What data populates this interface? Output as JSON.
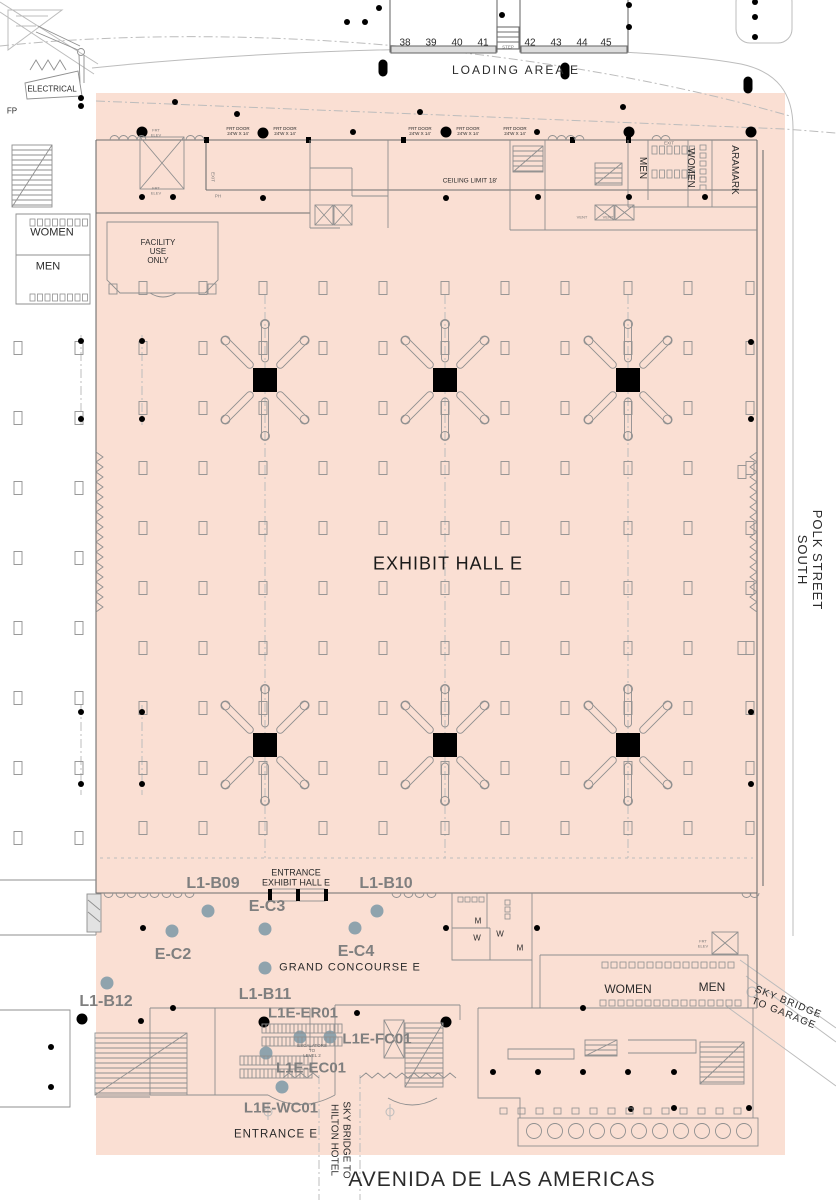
{
  "colors": {
    "hall_fill": "#fadfd3",
    "wall": "#6f6f6f",
    "road": "#bcbcbc",
    "marker": "#8fa3ad",
    "label_gray": "#7f7f7f",
    "black": "#000000"
  },
  "loading_dock": {
    "area_label": "LOADING AREA E",
    "numbers": [
      "38",
      "39",
      "40",
      "41",
      "42",
      "43",
      "44",
      "45"
    ],
    "step_label": "STEP"
  },
  "site": {
    "electrical": "ELECTRICAL",
    "fp": "FP",
    "polk_line1": "POLK STREET",
    "polk_line2": "SOUTH",
    "avenida": "AVENIDA DE LAS AMERICAS",
    "sky_garage_line1": "SKY BRIDGE",
    "sky_garage_line2": "TO GARAGE",
    "sky_hilton_line1": "SKY BRIDGE TO",
    "sky_hilton_line2": "HILTON HOTEL"
  },
  "hall": {
    "name": "EXHIBIT HALL E",
    "ceiling_note": "CEILING LIMIT 18'",
    "frt_door_line1": "FRT DOOR",
    "frt_door_line2": "24'W X 14'",
    "frt_elev_line1": "FRT",
    "frt_elev_line2": "ELEV",
    "exit": "EXIT",
    "ph": "PH",
    "vent": "VENT",
    "entrance_line1": "ENTRANCE",
    "entrance_line2": "EXHIBIT HALL E"
  },
  "rooms": {
    "facility_line1": "FACILITY",
    "facility_line2": "USE",
    "facility_line3": "ONLY",
    "women_left": "WOMEN",
    "men_left": "MEN",
    "men_top": "MEN",
    "women_top": "WOMEN",
    "aramark": "ARAMARK",
    "women_br": "WOMEN",
    "men_br": "MEN",
    "m1": "M",
    "w1": "W",
    "w2": "W",
    "m2": "M"
  },
  "concourse": {
    "grand_label": "GRAND CONCOURSE E",
    "entrance_e": "ENTRANCE E",
    "escalators_line1": "ESCALATORS",
    "escalators_line2": "TO",
    "escalators_line3": "LEVEL 2"
  },
  "markers": {
    "booths": [
      "L1-B09",
      "L1-B10",
      "L1-B11",
      "L1-B12"
    ],
    "points": [
      "E-C2",
      "E-C3",
      "E-C4"
    ],
    "facilities": [
      "L1E-ER01",
      "L1E-FC01",
      "L1E-EC01",
      "L1E-WC01"
    ]
  },
  "geometry": {
    "hall_grid": {
      "cols": [
        143,
        203,
        263,
        323,
        383,
        445,
        505,
        565,
        628,
        688,
        750
      ],
      "rows": [
        288,
        348,
        408,
        468,
        528,
        588,
        648,
        708,
        768,
        828
      ],
      "w": 8,
      "h": 13
    },
    "left_grid": {
      "cols": [
        18,
        79
      ],
      "rows": [
        348,
        418,
        488,
        558,
        628,
        698,
        768,
        838
      ],
      "w": 8,
      "h": 13
    },
    "right_grid": {
      "cols": [
        742
      ],
      "rows": [
        472,
        648
      ],
      "w": 8,
      "h": 13
    },
    "trusses": [
      [
        265,
        380
      ],
      [
        445,
        380
      ],
      [
        628,
        380
      ],
      [
        265,
        745
      ],
      [
        445,
        745
      ],
      [
        628,
        745
      ]
    ],
    "gray_markers": [
      [
        208,
        911
      ],
      [
        377,
        911
      ],
      [
        172,
        931
      ],
      [
        265,
        929
      ],
      [
        355,
        928
      ],
      [
        265,
        968
      ],
      [
        107,
        983
      ],
      [
        300,
        1037
      ],
      [
        330,
        1037
      ],
      [
        266,
        1053
      ],
      [
        282,
        1087
      ]
    ],
    "dots_large": [
      [
        142,
        132
      ],
      [
        263,
        133
      ],
      [
        446,
        132
      ],
      [
        629,
        132
      ],
      [
        751,
        132
      ],
      [
        82,
        1019
      ],
      [
        264,
        1022
      ],
      [
        446,
        1022
      ]
    ],
    "dots_small": [
      [
        379,
        8
      ],
      [
        502,
        15
      ],
      [
        629,
        5
      ],
      [
        629,
        27
      ],
      [
        755,
        2
      ],
      [
        755,
        17
      ],
      [
        755,
        37
      ],
      [
        347,
        22
      ],
      [
        365,
        22
      ],
      [
        623,
        107
      ],
      [
        420,
        112
      ],
      [
        175,
        102
      ],
      [
        237,
        114
      ],
      [
        81,
        98
      ],
      [
        81,
        106
      ],
      [
        142,
        197
      ],
      [
        173,
        197
      ],
      [
        263,
        198
      ],
      [
        446,
        198
      ],
      [
        538,
        197
      ],
      [
        629,
        197
      ],
      [
        705,
        197
      ],
      [
        353,
        132
      ],
      [
        537,
        132
      ],
      [
        81,
        341
      ],
      [
        81,
        419
      ],
      [
        142,
        341
      ],
      [
        142,
        419
      ],
      [
        81,
        712
      ],
      [
        81,
        784
      ],
      [
        142,
        712
      ],
      [
        142,
        784
      ],
      [
        751,
        342
      ],
      [
        751,
        419
      ],
      [
        751,
        712
      ],
      [
        751,
        784
      ],
      [
        143,
        928
      ],
      [
        446,
        928
      ],
      [
        537,
        928
      ],
      [
        173,
        1008
      ],
      [
        141,
        1021
      ],
      [
        357,
        1013
      ],
      [
        583,
        1008
      ],
      [
        51,
        1047
      ],
      [
        51,
        1087
      ],
      [
        493,
        1072
      ],
      [
        538,
        1072
      ],
      [
        583,
        1072
      ],
      [
        628,
        1072
      ],
      [
        674,
        1072
      ],
      [
        631,
        1109
      ],
      [
        674,
        1108
      ],
      [
        749,
        1108
      ]
    ],
    "pills": [
      [
        383,
        68
      ],
      [
        565,
        71
      ],
      [
        748,
        85
      ]
    ],
    "fixture_rows": [
      [
        30,
        219,
        8,
        7.5,
        0,
        5,
        7
      ],
      [
        30,
        294,
        8,
        7.5,
        0,
        5,
        7
      ],
      [
        652,
        146,
        6,
        7.5,
        0,
        5,
        8
      ],
      [
        652,
        170,
        6,
        7.5,
        0,
        5,
        8
      ],
      [
        700,
        145,
        6,
        0,
        8,
        6,
        5
      ],
      [
        602,
        962,
        15,
        9,
        0,
        6,
        6
      ],
      [
        600,
        1000,
        16,
        9,
        0,
        6,
        6
      ],
      [
        458,
        897,
        4,
        7,
        0,
        5,
        5
      ],
      [
        505,
        900,
        3,
        0,
        7,
        5,
        5
      ],
      [
        500,
        1108,
        14,
        18,
        0,
        7,
        6
      ]
    ],
    "stairs": [
      [
        12,
        145,
        40,
        62
      ],
      [
        513,
        146,
        30,
        26
      ],
      [
        595,
        163,
        27,
        22
      ],
      [
        95,
        1033,
        92,
        62
      ],
      [
        405,
        1023,
        38,
        64
      ],
      [
        700,
        1042,
        44,
        42
      ],
      [
        585,
        1040,
        32,
        16
      ]
    ],
    "escalators": [
      [
        262,
        1024,
        80
      ],
      [
        240,
        1056,
        72
      ]
    ],
    "xboxes": [
      [
        140,
        137,
        44,
        52
      ],
      [
        315,
        205,
        18,
        20
      ],
      [
        334,
        205,
        18,
        20
      ],
      [
        595,
        205,
        19,
        15
      ],
      [
        615,
        205,
        19,
        15
      ],
      [
        712,
        932,
        26,
        22
      ],
      [
        384,
        1020,
        20,
        38
      ]
    ],
    "food_circles": [
      534,
      555,
      576,
      597,
      618,
      639,
      660,
      681,
      702,
      723,
      744
    ],
    "zigzags_v": [
      [
        96,
        452,
        612,
        7
      ],
      [
        757,
        452,
        612,
        -7
      ]
    ],
    "zigzags_h": [
      [
        283,
        1078,
        319
      ],
      [
        360,
        1078,
        456
      ]
    ],
    "bumps": [
      {
        "y": 140,
        "up": 1,
        "xs": [
          110,
          119,
          128,
          137,
          186,
          195,
          548,
          557,
          566,
          575,
          652,
          661
        ]
      },
      {
        "y": 893,
        "up": 0,
        "xs": [
          104,
          116,
          127,
          139,
          150,
          162,
          173,
          185,
          392,
          404,
          415,
          427,
          742,
          750
        ]
      }
    ]
  }
}
